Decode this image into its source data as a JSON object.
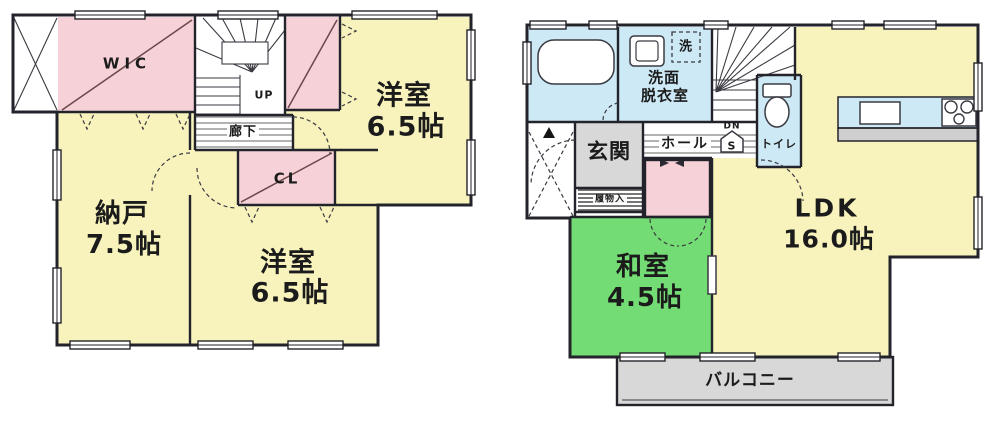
{
  "meta": {
    "type": "japanese-floor-plan",
    "floors_shown": 2
  },
  "palette": {
    "wall": "#23232b",
    "room_yellow": "#F8F3BC",
    "room_pink": "#F6D2D8",
    "room_green": "#74DC74",
    "room_blue": "#CCE9F5",
    "gray_area": "#D8D8D8",
    "counter_face": "#CFCFCF",
    "text": "#1b1b1b"
  },
  "icons": {
    "bathtub": "bathtub-icon",
    "toilet": "toilet-icon",
    "vanity_sink": "sink-icon",
    "washing_machine": "washer-icon",
    "kitchen_sink": "kitchen-sink-icon",
    "stove": "stove-burners-icon",
    "entrance_marker": "entrance-triangle-icon",
    "understairs_storage": "storage-pentagon-icon"
  },
  "floor2": {
    "wic_label": "WIC",
    "stairs_label": "UP",
    "hallway_label": "廊下",
    "closet_label": "CL",
    "storage_room": {
      "name": "納戸",
      "size": "7.5帖"
    },
    "bedroom_top": {
      "name": "洋室",
      "size": "6.5帖"
    },
    "bedroom_bottom": {
      "name": "洋室",
      "size": "6.5帖"
    }
  },
  "floor1": {
    "entrance_label": "玄関",
    "hall_label": "ホール",
    "washroom": {
      "line1": "洗面",
      "line2": "脱衣室"
    },
    "washer_label": "洗",
    "toilet_label": "トイレ",
    "stairs_label": "DN",
    "understairs_label": "S",
    "shoe_storage_label": "履物入",
    "ldk": {
      "name": "LDK",
      "size": "16.0帖"
    },
    "japanese_room": {
      "name": "和室",
      "size": "4.5帖"
    },
    "balcony_label": "バルコニー"
  }
}
